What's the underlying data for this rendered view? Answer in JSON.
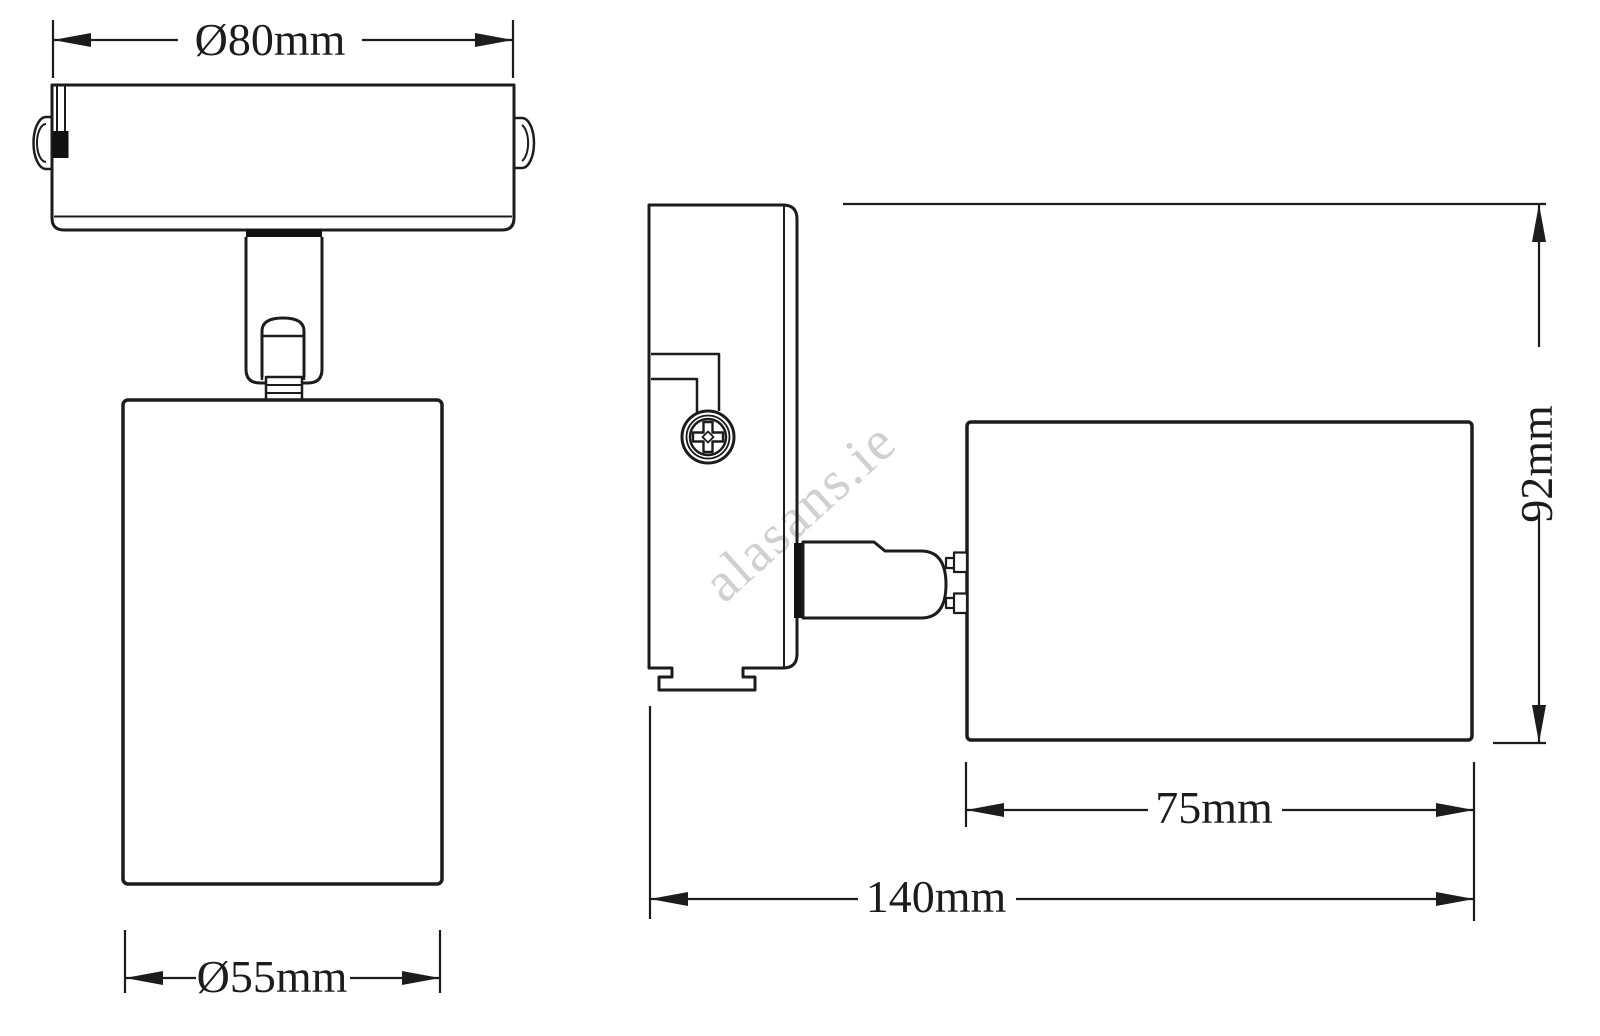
{
  "drawing": {
    "type": "technical-dimension-drawing",
    "subject": "wall/ceiling spotlight, front view and side view"
  },
  "watermark": {
    "text": "alasans.ie",
    "color": "#c8c8c8"
  },
  "dimensions": {
    "canopy_diameter": "Ø80mm",
    "head_diameter": "Ø55mm",
    "height": "92mm",
    "head_length": "75mm",
    "overall_length": "140mm"
  },
  "colors": {
    "line": "#1c1c1c",
    "fill_black": "#111111",
    "background": "#ffffff",
    "watermark": "#c8c8c8"
  }
}
